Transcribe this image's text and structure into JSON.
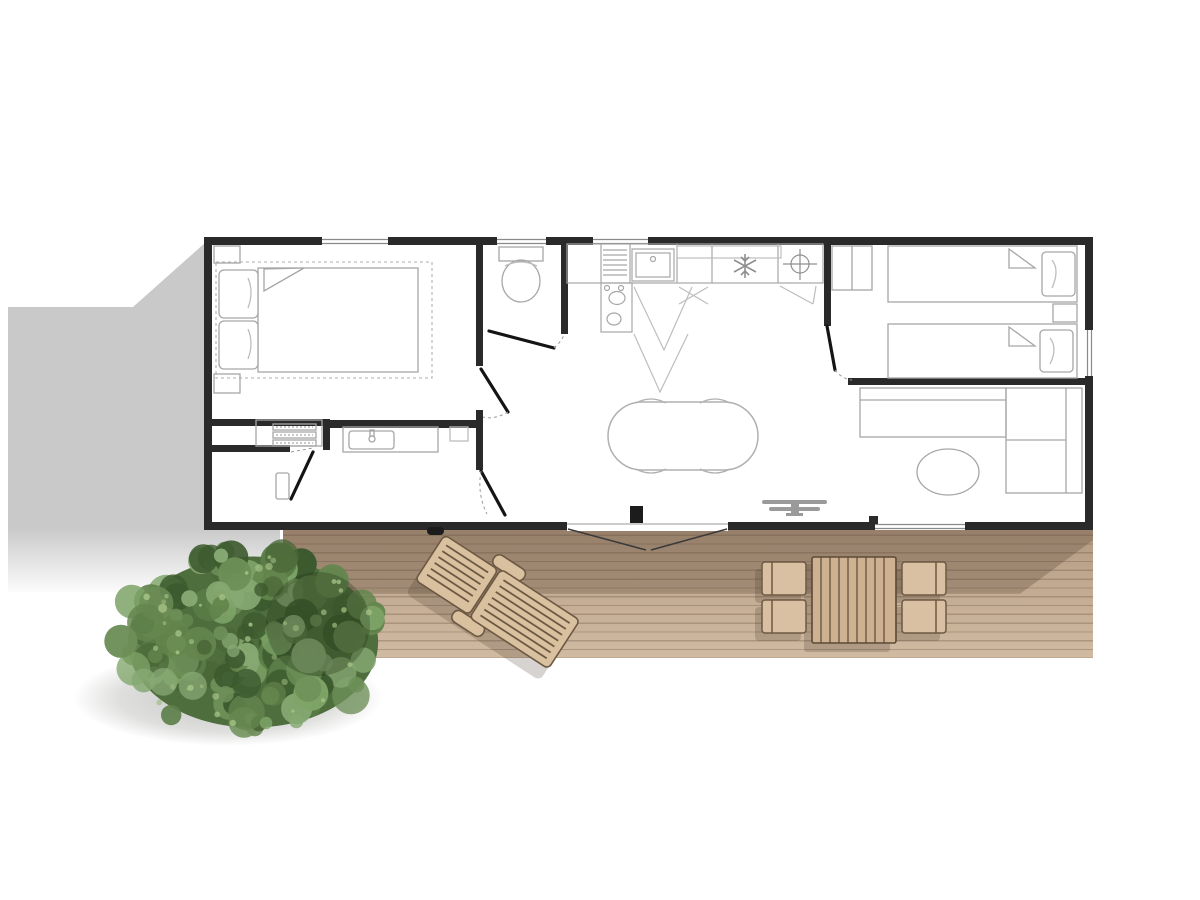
{
  "title": "mobile-home floor plan, top view, with terrace deck and tree",
  "visible_text": [],
  "colors": {
    "bg": "#ffffff",
    "wall": "#2a2a2a",
    "wall_light": "#8a8a8a",
    "furniture_line": "#a6a6a6",
    "furniture_line_soft": "#bdbdbd",
    "door_leaf": "#141414",
    "shadow_gray": "#c9c9c9",
    "deck_top": "#b29982",
    "deck_mid": "#c2aa92",
    "deck_bottom": "#d1baa2",
    "plank_line": "rgba(96,74,54,0.30)",
    "deck_shadow": "rgba(88,69,52,0.30)",
    "outdoor_wood_fill": "#d9c09f",
    "outdoor_wood_stroke": "#6d5943",
    "outdoor_table_fill": "#cdb191",
    "item_shadow": "rgba(70,55,40,0.25)",
    "tree_base": "#4f6e3d",
    "tree_shadow": "rgba(75,75,70,0.30)"
  },
  "building": {
    "rooms": [
      {
        "name": "master-bedroom",
        "features": [
          "double-bed",
          "pillows",
          "nightstands",
          "dotted-bed-outline",
          "closet-shelves"
        ]
      },
      {
        "name": "wc",
        "features": [
          "toilet"
        ]
      },
      {
        "name": "kitchen",
        "features": [
          "sink",
          "drainer",
          "hob-burners",
          "fridge-snowflake",
          "extractor-cross",
          "cabinet-swings"
        ]
      },
      {
        "name": "shower-room",
        "features": [
          "washbasin-vanity",
          "mirror"
        ]
      },
      {
        "name": "twin-bedroom",
        "features": [
          "single-bed",
          "single-bed",
          "pillows",
          "nightstand",
          "wardrobe"
        ]
      },
      {
        "name": "living-room",
        "features": [
          "corner-sofa",
          "round-pouf",
          "oval-dining-table",
          "chairs",
          "tv"
        ]
      }
    ],
    "openings": [
      "patio-double-door",
      "interior-doors",
      "windows"
    ]
  },
  "deck": {
    "planks": "horizontal",
    "items": [
      "sun-lounger",
      "outdoor-table",
      "four-chairs",
      "door-step"
    ]
  },
  "tree": {
    "cx": 253,
    "cy": 642,
    "rx": 136,
    "ry": 93,
    "blobs": 150,
    "rmin": 6,
    "rmax": 19,
    "seed": 7,
    "palette": [
      "#6d8f58",
      "#5b7d47",
      "#4a6838",
      "#7ea468",
      "#3c5a2e",
      "#86a872",
      "#64864e"
    ],
    "highlights": 40,
    "highlight_color": "#a3c184",
    "dark_patch": {
      "cx": 318,
      "cy": 624,
      "r": 52,
      "color": "rgba(28,44,18,0.28)"
    }
  }
}
